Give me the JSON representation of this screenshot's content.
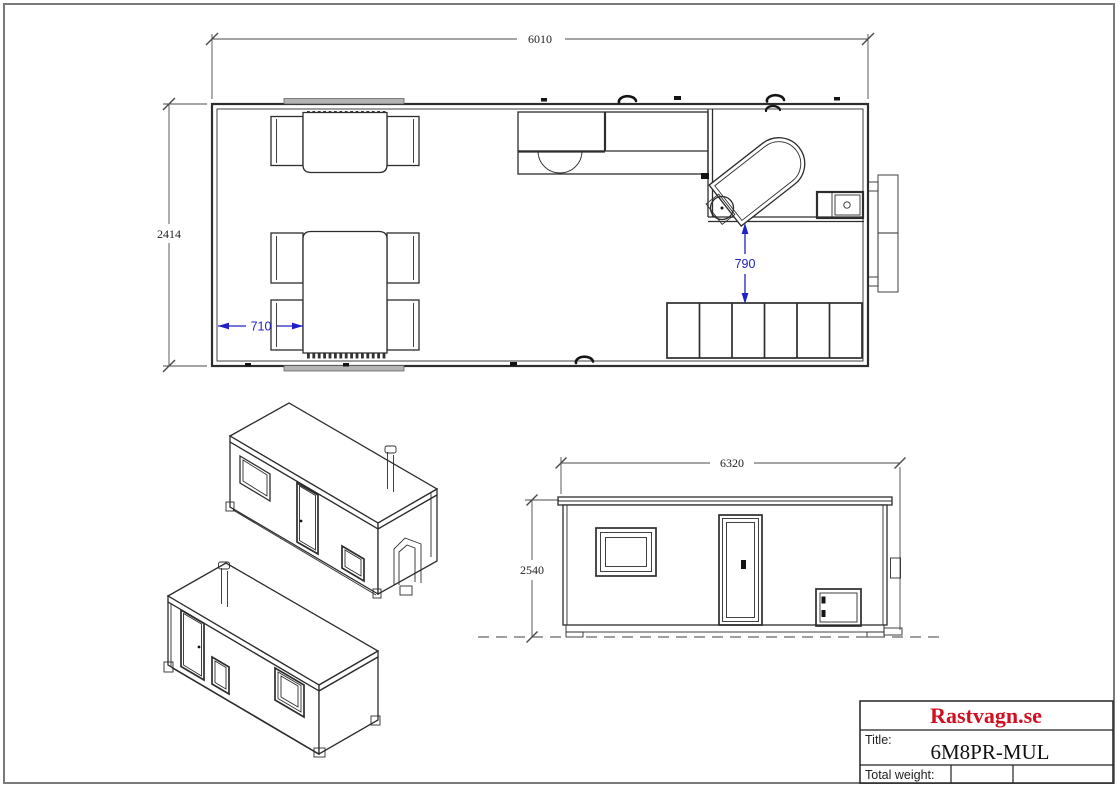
{
  "colors": {
    "line": "#2d2d2d",
    "dim_line": "#4a4a4a",
    "dim_blue": "#2020c8",
    "brand_red": "#d01020",
    "page_border": "#7a7a7a"
  },
  "drawing": {
    "plan": {
      "length_dim": "6010",
      "width_dim": "2414",
      "table_clearance_dim": "710",
      "wc_clearance_dim": "790"
    },
    "elevation": {
      "length_dim": "6320",
      "height_dim": "2540"
    }
  },
  "title_block": {
    "brand": "Rastvagn.se",
    "title_label": "Title:",
    "title_value": "6M8PR-MUL",
    "weight_label": "Total weight:",
    "weight_value": ""
  }
}
